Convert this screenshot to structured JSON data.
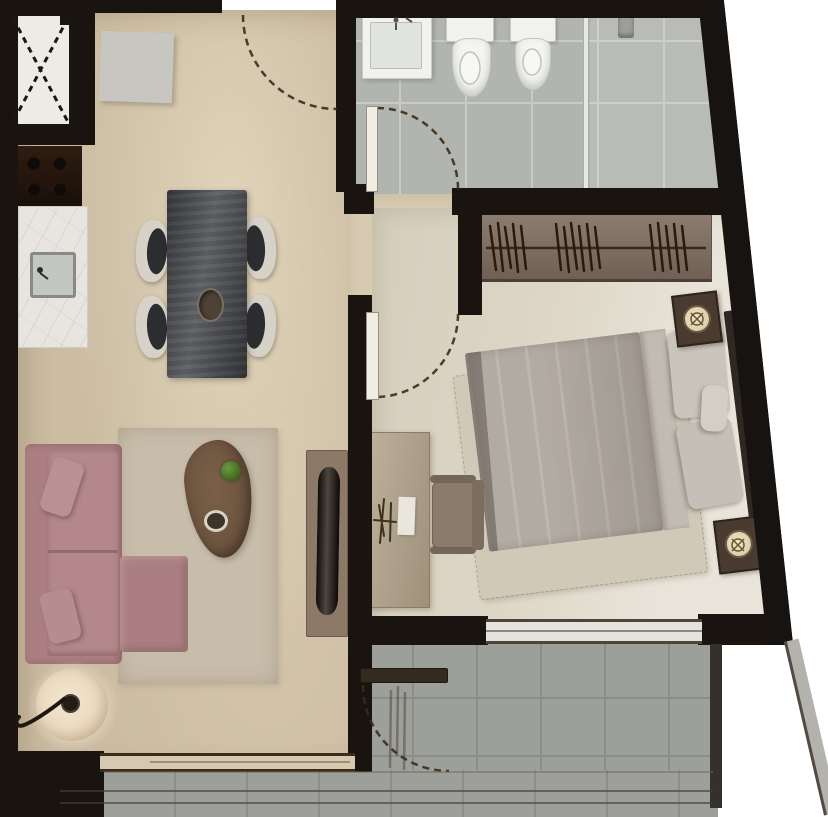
{
  "meta": {
    "kind": "apartment-floor-plan",
    "style": "rendered-top-view",
    "text_labels": []
  },
  "colors": {
    "wall": "#1a1410",
    "exterior": "#ffffff",
    "floor_main": "#cbbca2",
    "floor_hall": "#d6cab1",
    "floor_bedroom": "#ddd6c6",
    "floor_bath": "#b2b4b0",
    "floor_balcony": "#9da09a",
    "door_arc": "#3c2b18",
    "sofa": "#ab7f82",
    "rug_living": "#c8bdaa",
    "coffee_table": "#6a523f",
    "plant": "#4f7c2b",
    "dining_table": "#4b4d52",
    "chair_shell": "#d6d2c8",
    "chair_seat": "#2c2d31",
    "wardrobe": "#806d60",
    "bed_duvet": "#aca49c",
    "bed_pillow": "#cbc4bd",
    "bed_rug": "#d0c9b8",
    "headboard": "#2f2822",
    "nightstand": "#4a3b30",
    "desk": "#ac9d84",
    "desk_chair": "#8a7b6c",
    "tv_console": "#8d7968",
    "tv": "#241e19",
    "counter": "#e8e5e0",
    "stove": "#241a11",
    "sink": "#c3c6c2",
    "fixture_white": "#f1f2f0",
    "glass": "#e6e8e4",
    "slider": "#e4e3de",
    "parapet": "#b4b2ac"
  },
  "rooms": [
    {
      "id": "kitchen-dining",
      "items": [
        "utility-shaft-x",
        "tall-cabinet",
        "cooktop",
        "counter-with-sink",
        "dining-table",
        "dining-chairs-x4",
        "table-bowl"
      ]
    },
    {
      "id": "living",
      "items": [
        "l-shaped-sofa",
        "throw-pillows-x2",
        "area-rug",
        "pebble-coffee-table",
        "potted-plant",
        "decor-bowl",
        "floor-lamp",
        "tv-console",
        "tv"
      ]
    },
    {
      "id": "bathroom",
      "items": [
        "washbasin",
        "toilet",
        "bidet",
        "shower-glass-partition",
        "shower-head"
      ]
    },
    {
      "id": "bedroom",
      "items": [
        "wardrobe-with-hangers",
        "double-bed",
        "bed-pillows-x3",
        "nightstand-with-lamp-x2",
        "bed-rug",
        "desk",
        "desk-chair",
        "desk-lamp",
        "notepad"
      ]
    },
    {
      "id": "balcony",
      "items": [
        "tiled-deck",
        "railing"
      ]
    }
  ],
  "doors": [
    {
      "id": "entry-door",
      "swing": "quarter-arc"
    },
    {
      "id": "bathroom-door",
      "swing": "quarter-arc"
    },
    {
      "id": "bedroom-door",
      "swing": "quarter-arc"
    },
    {
      "id": "balcony-door",
      "swing": "quarter-arc"
    },
    {
      "id": "bedroom-balcony-slider",
      "swing": "sliding"
    }
  ]
}
